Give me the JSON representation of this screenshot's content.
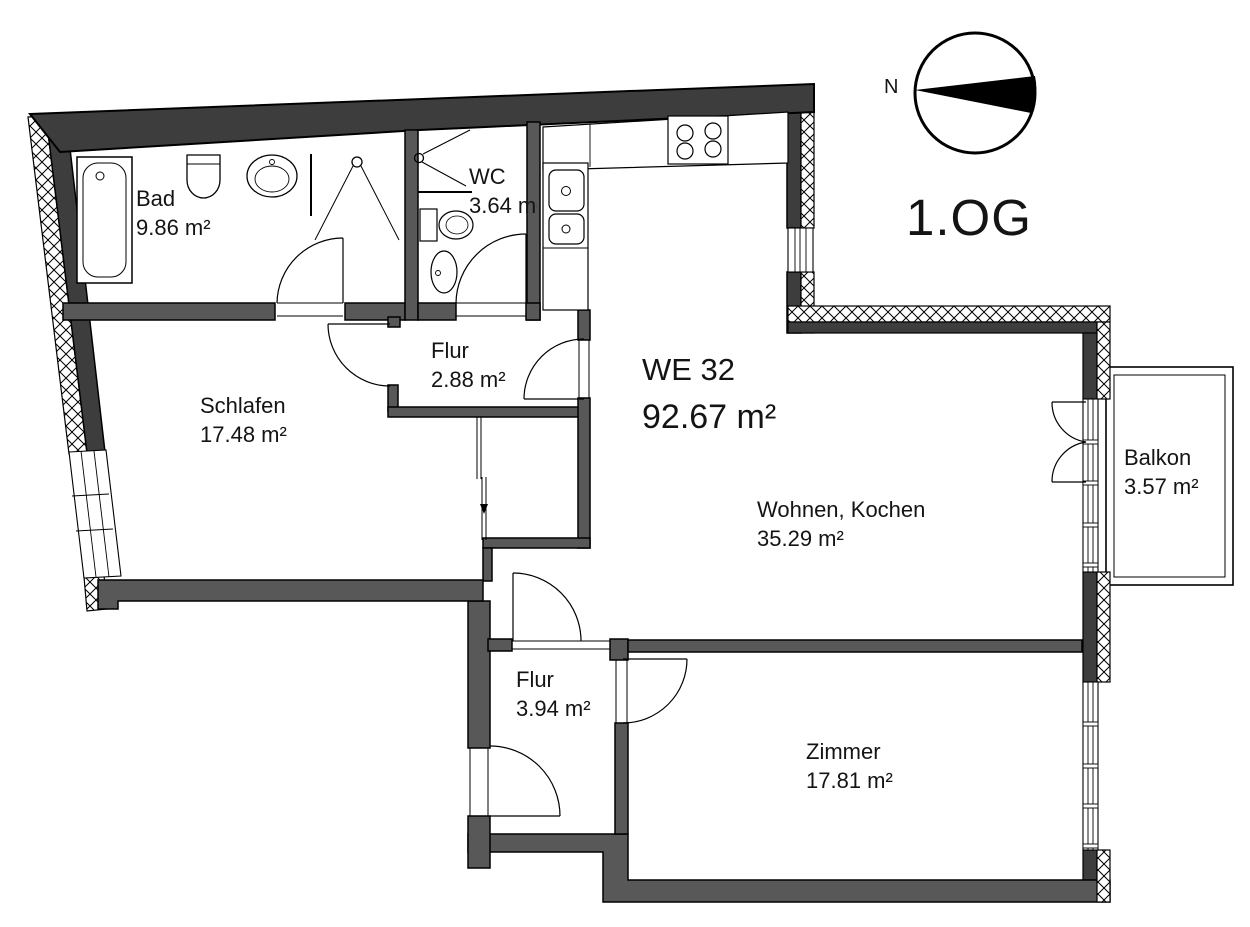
{
  "header": {
    "unit_label": "WE 32",
    "total_area": "92.67  m²",
    "floor_label": "1.OG",
    "compass_north": "N"
  },
  "rooms": {
    "bad": {
      "name": "Bad",
      "area": "9.86 m²"
    },
    "wc": {
      "name": "WC",
      "area": "3.64 m²"
    },
    "flur_upper": {
      "name": "Flur",
      "area": "2.88 m²"
    },
    "schlafen": {
      "name": "Schlafen",
      "area": "17.48 m²"
    },
    "wohnen": {
      "name": "Wohnen, Kochen",
      "area": "35.29 m²"
    },
    "balkon": {
      "name": "Balkon",
      "area": "3.57 m²"
    },
    "flur_lower": {
      "name": "Flur",
      "area": "3.94 m²"
    },
    "zimmer": {
      "name": "Zimmer",
      "area": "17.81 m²"
    }
  },
  "colors": {
    "wall_exterior": "#3d3d3d",
    "wall_interior": "#585858",
    "outline": "#000000",
    "text": "#141414",
    "background": "#ffffff"
  }
}
